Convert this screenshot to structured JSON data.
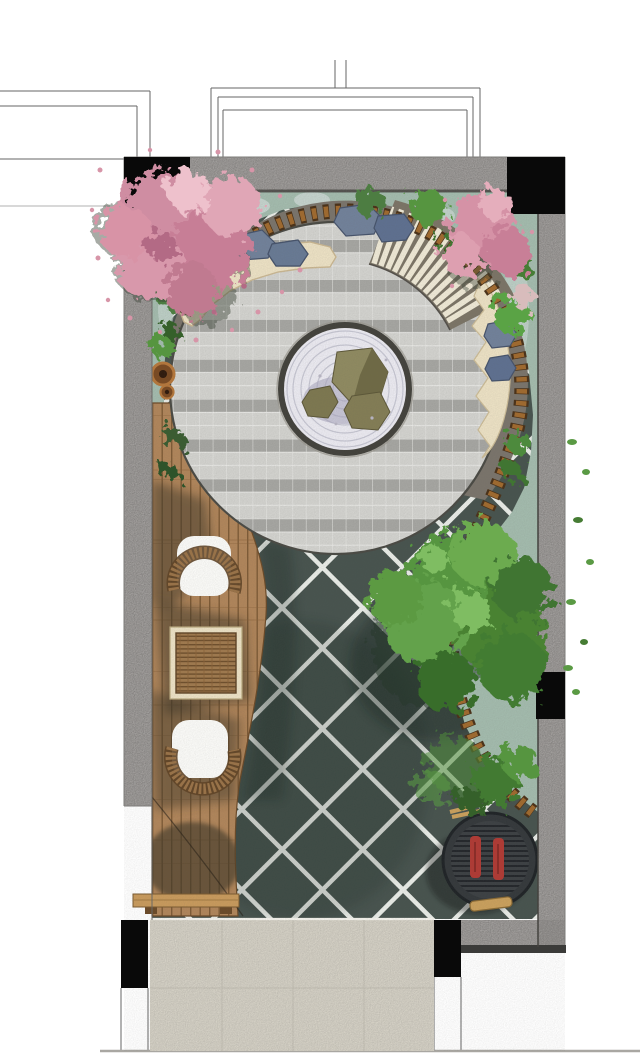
{
  "scene": {
    "name": "courtyard-garden-landscape-plan",
    "width": 640,
    "height": 1058,
    "view": "top-down rendered site plan, no visible text"
  },
  "palette": {
    "paper": "#ffffff",
    "wall": "#a3a09e",
    "wall_edge": "#7e7c7a",
    "column": "#090909",
    "bed": "#a3bbad",
    "bed_patch": "#ccd8d3",
    "ring": "#7a746b",
    "tile_light": "#d3d3cf",
    "tile_band": "#a6a6a2",
    "deck_base": "#b0855a",
    "deck_grain": "#7e5b36",
    "lattice": "#47534e",
    "lattice_line": "#e9ece7",
    "sand": "#ece1c4",
    "zen_gravel": "#ebeaf1",
    "zen_ring": "#43423c",
    "zen_rake": "#c6c6d2",
    "rock_olive": "#8f8a60",
    "rock_olive_dark": "#6f6a45",
    "boulder": "#71819a",
    "boulder_dark": "#46536b",
    "tie_light": "#a06a2e",
    "tie_dark": "#4a3118",
    "pink_tree": "#cf8da2",
    "pink_tree_light": "#e0a6b6",
    "green_tree": "#57953f",
    "green_tree_dark": "#3a6d2c",
    "entry_paving": "#dad6ca",
    "stripe": "#efe9d6",
    "bbq_body": "#34383b",
    "bbq_grate": "#23262a",
    "bbq_food": "#b03a34",
    "bench_wood": "#c89a5c",
    "chair_white": "#fbfbf8",
    "wicker": "#8f6a42",
    "shadow": "#3b3428",
    "line": "#4a4a4a"
  },
  "features": {
    "plaza": "circular tiled plaza with dark ring walkway",
    "zen_garden": "central raked-gravel circle with three olive rocks",
    "ramp": "radial white-striped step ramp on upper-right of ring",
    "tie_edge": "curved timber-tie edging from upper-left around to lower-right corner",
    "sand_seats": "two cream organic sand/bench shapes on ring",
    "boulder_clusters": 3,
    "deck": "wood plank deck on left with two white lounge chairs and wicker table",
    "lattice_paving": "dark diagonal-lattice paving lower half",
    "bbq": "round charcoal grill with two red skewers, lower right",
    "entry": "beige paved entry opening at bottom",
    "trees": [
      "pink blossom tree top-left",
      "pink blossom tree top-right",
      "large green tree right",
      "green shrub cluster lower-right"
    ],
    "pots": 2,
    "bench": "small timber bench at deck bottom",
    "columns": 5
  }
}
